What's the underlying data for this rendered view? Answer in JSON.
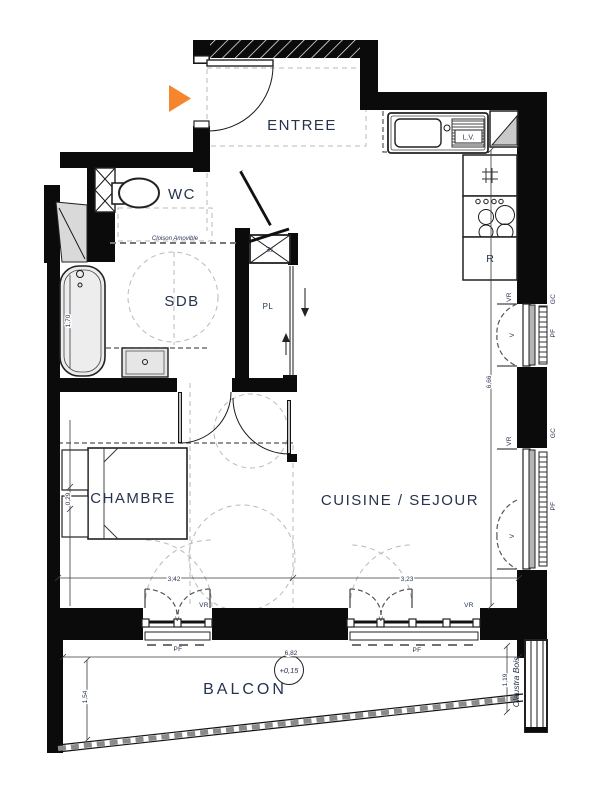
{
  "title": "Apartment floor plan",
  "rooms": {
    "entree": "ENTREE",
    "wc": "WC",
    "sdb": "SDB",
    "placard": "PL",
    "chambre": "CHAMBRE",
    "cuisine_sejour": "CUISINE / SEJOUR",
    "balcon": "BALCON"
  },
  "fixtures": {
    "dishwasher": "L.V.",
    "fridge": "R",
    "electrical_panel": "TE"
  },
  "openings": {
    "roller_shutter": "VR",
    "french_window": "PF",
    "guard_rail": "GC",
    "window_leaf": "V"
  },
  "annotations": {
    "removable_partition": "Cloison Amovible",
    "wood_screen": "Claustra Bois",
    "balcony_level": "+0,15"
  },
  "dimensions": {
    "bathtub_length": "1,70",
    "chambre_width": "3,42",
    "sejour_width": "3,23",
    "facade_height": "6,66",
    "balcony_depth": "1,54",
    "balcony_length": "6,82",
    "claustra_length": "1,19",
    "bed_offset": "0,29"
  },
  "colors": {
    "entry_arrow": "#F6862D",
    "label_text": "#26334E",
    "wall": "#000000"
  }
}
